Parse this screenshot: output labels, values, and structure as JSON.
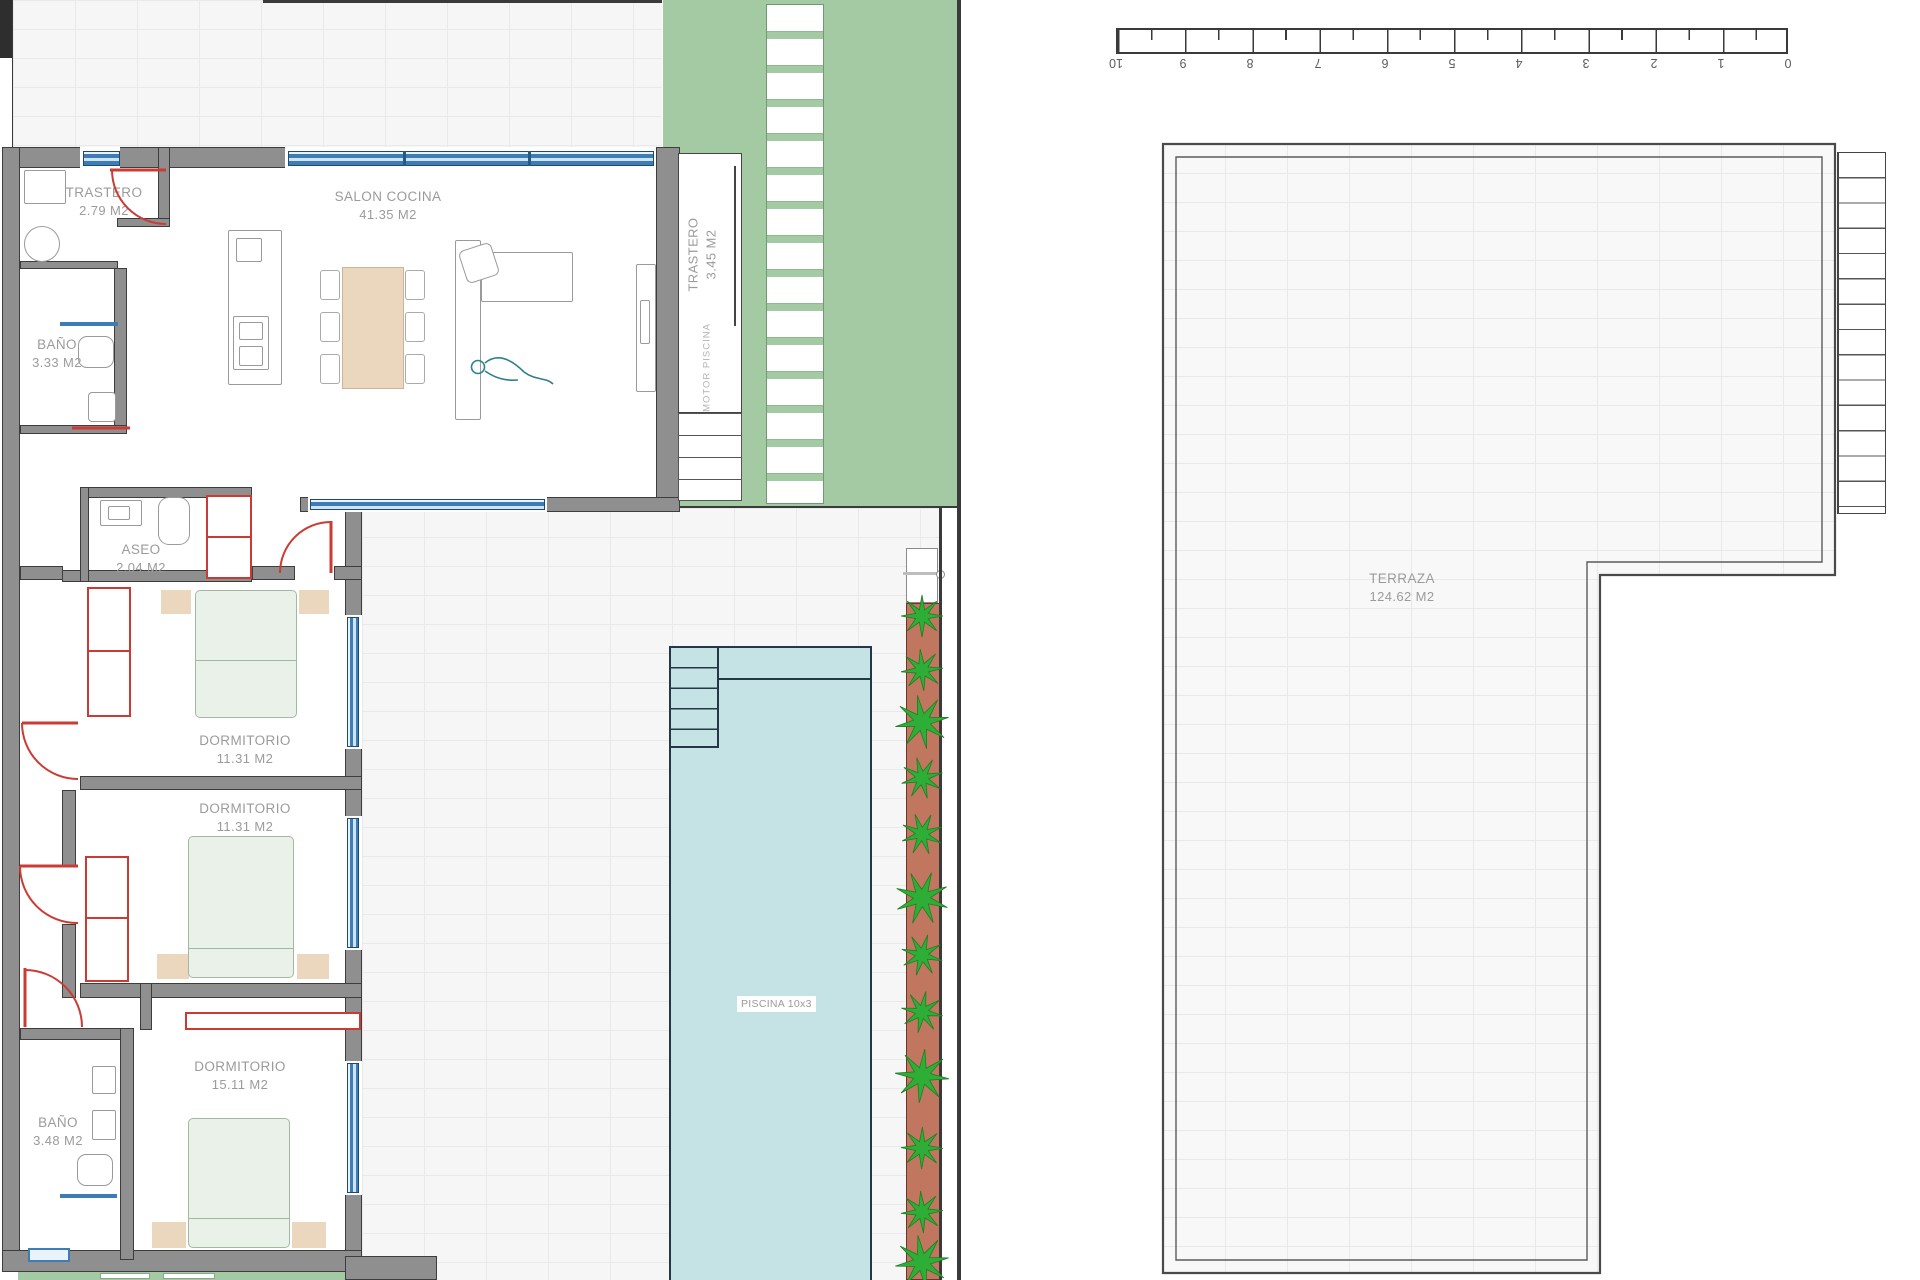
{
  "rooms": {
    "trastero_top": {
      "name": "TRASTERO",
      "area": "2.79 M2"
    },
    "salon": {
      "name": "SALON COCINA",
      "area": "41.35 M2"
    },
    "bano_top": {
      "name": "BAÑO",
      "area": "3.33 M2"
    },
    "trastero_ext": {
      "name": "TRASTERO",
      "area": "3.45 M2"
    },
    "motor": {
      "name": "MOTOR  PISCINA"
    },
    "aseo": {
      "name": "ASEO",
      "area": "2.04 M2"
    },
    "dorm1": {
      "name": "DORMITORIO",
      "area": "11.31 M2"
    },
    "dorm2": {
      "name": "DORMITORIO",
      "area": "11.31 M2"
    },
    "dorm3": {
      "name": "DORMITORIO",
      "area": "15.11 M2"
    },
    "bano_bottom": {
      "name": "BAÑO",
      "area": "3.48 M2"
    },
    "piscina": {
      "label": "PISCINA 10x3"
    },
    "terraza": {
      "name": "TERRAZA",
      "area": "124.62 M2"
    }
  },
  "ruler": {
    "labels": [
      "10",
      "9",
      "8",
      "7",
      "6",
      "5",
      "4",
      "3",
      "2",
      "1",
      "0"
    ],
    "segment_px": 67.2
  },
  "planter": {
    "plant_ys": [
      616,
      670,
      722,
      778,
      834,
      898,
      955,
      1012,
      1076,
      1148,
      1212,
      1262
    ],
    "plant_x": 922
  },
  "colors": {
    "wall": "#8f8f8f",
    "wall_edge": "#3d3d3d",
    "window_blue": "#3e7cb6",
    "door_red": "#cc3b33",
    "garden_green": "#a4caa4",
    "pool_fill": "#c5e3e5",
    "pool_edge": "#233744",
    "planter_terracotta": "#c1775f",
    "plant_green": "#2fae37",
    "bed_green": "#e9f1e8",
    "wood_tan": "#ead7bd",
    "label_gray": "#9b9b9b"
  }
}
